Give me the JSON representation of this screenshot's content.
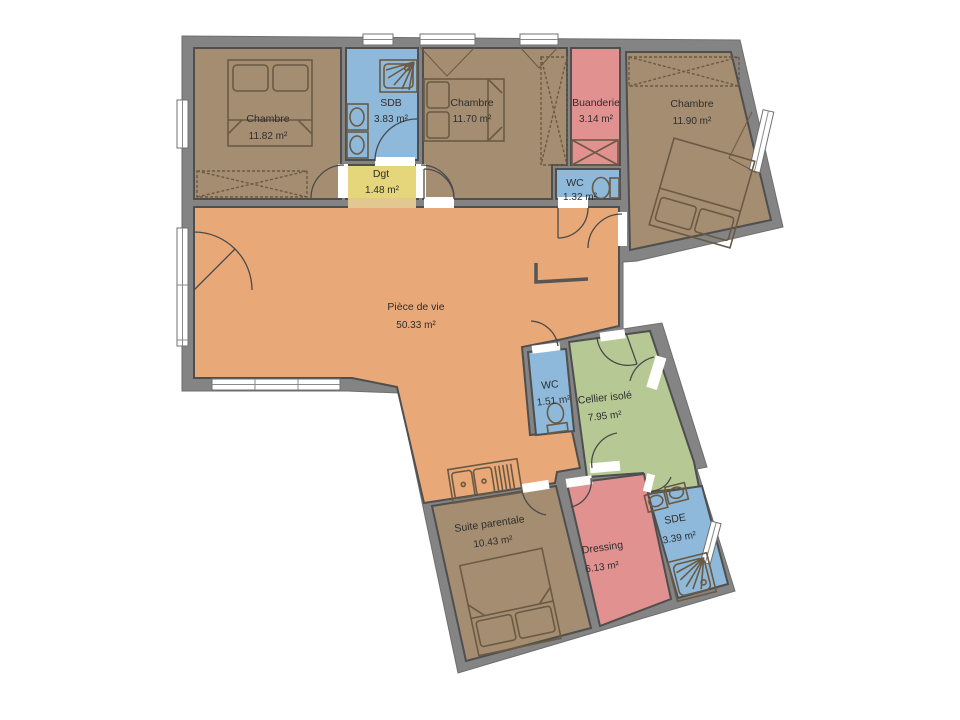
{
  "plan": {
    "rooms": [
      {
        "id": "chambre-1",
        "name": "Chambre",
        "area": "11.82 m²"
      },
      {
        "id": "sdb",
        "name": "SDB",
        "area": "3.83 m²"
      },
      {
        "id": "dgt",
        "name": "Dgt",
        "area": "1.48 m²"
      },
      {
        "id": "chambre-2",
        "name": "Chambre",
        "area": "11.70 m²"
      },
      {
        "id": "buanderie",
        "name": "Buanderie",
        "area": "3.14 m²"
      },
      {
        "id": "wc-1",
        "name": "WC",
        "area": "1.32 m²"
      },
      {
        "id": "chambre-3",
        "name": "Chambre",
        "area": "11.90 m²"
      },
      {
        "id": "piece-de-vie",
        "name": "Pièce de vie",
        "area": "50.33 m²"
      },
      {
        "id": "wc-2",
        "name": "WC",
        "area": "1.51 m²"
      },
      {
        "id": "cellier",
        "name": "Cellier isolé",
        "area": "7.95 m²"
      },
      {
        "id": "suite-parentale",
        "name": "Suite parentale",
        "area": "10.43 m²"
      },
      {
        "id": "dressing",
        "name": "Dressing",
        "area": "6.13 m²"
      },
      {
        "id": "sde",
        "name": "SDE",
        "area": "3.39 m²"
      }
    ],
    "colors": {
      "wall": "#848484",
      "bedroom": "#a58d71",
      "living": "#e9a877",
      "wet_room": "#8fb9da",
      "laundry_dressing": "#e29191",
      "degagement": "#e5d67c",
      "cellar": "#b6c994",
      "background": "#ffffff"
    }
  }
}
